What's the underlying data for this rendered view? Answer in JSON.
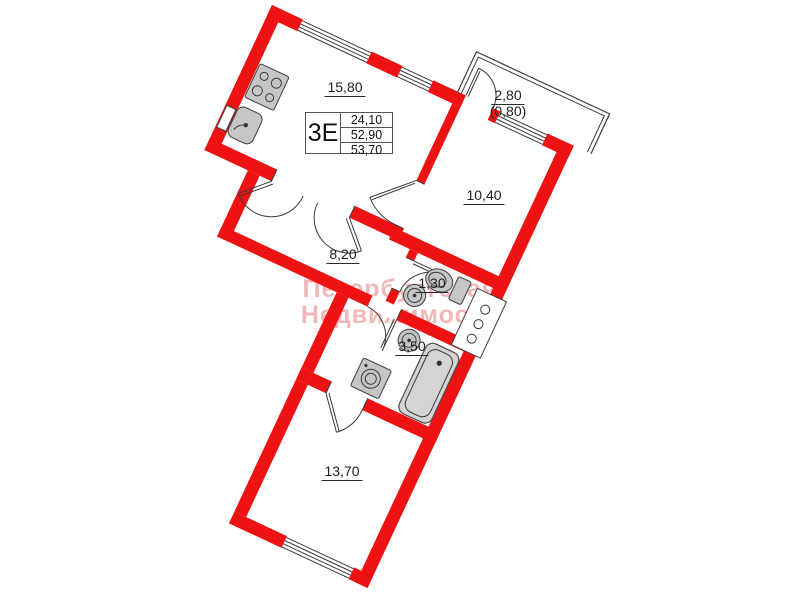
{
  "unit_info": {
    "type": "3Е",
    "values": [
      "24,10",
      "52,90",
      "53,70"
    ]
  },
  "rooms": {
    "kitchen_living": "15,80",
    "room_main": "10,40",
    "hallway": "8,20",
    "wc": "1,30",
    "bathroom": "3,50",
    "bedroom": "13,70",
    "balcony": "2,80",
    "balcony_reduced": "(0,80)"
  },
  "watermark": {
    "line1": "Петербургская",
    "line2": "Недвижимость"
  },
  "colors": {
    "wall": "#ee1212",
    "line": "#3a3a3a",
    "fixture": "#c6c6c6",
    "labeltext": "#1f1f1f",
    "wm": "#eda0a0"
  }
}
